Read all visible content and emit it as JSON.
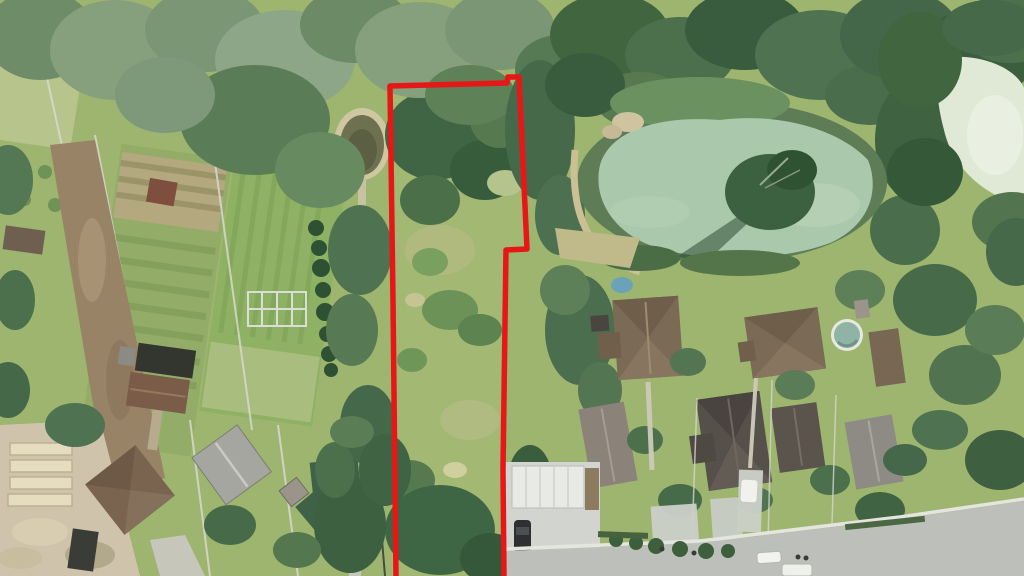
{
  "scene": {
    "description": "Aerial drone photograph of a long rural land plot outlined in red, flanked by garden allotments and a dirt road on the left, an algae-covered pond and detached houses with a residential street on the right",
    "type": "aerial-photo"
  },
  "boundary": {
    "color": "#e61717",
    "stroke_width": 5.5,
    "points": "396,578 393,300 390,86 507,83 508,77 519,77 527,249 506,250 503,470 504,578"
  },
  "palette": {
    "grass": "#9db56f",
    "plot_meadow": "#a2b873",
    "forest_dark": "#3c5f40",
    "willow_gray_green": "#86a07e",
    "pond_algae": "#aac8ab",
    "pond_pale": "#dfe9d6",
    "small_pond_water": "#6e7150",
    "small_pond_rim": "#cfc7a2",
    "dirt_road": "#998367",
    "construction_sand": "#cfc4ab",
    "asphalt": "#bcbfba",
    "concrete": "#d2d5cf",
    "roof_brown": "#7b6a55",
    "roof_dark": "#56504a",
    "roof_gray": "#a5a6a0",
    "roof_green": "#3e6147",
    "roof_red_brown": "#7e4f3e",
    "white_fence": "#d9d9d1",
    "car_white": "#f1f2ee",
    "car_dark": "#2e2f30",
    "pool_water": "#8fb3a4",
    "kiddie_pool": "#6aa3b8"
  },
  "features": {
    "outlined_plot": "vacant overgrown parcel marked with red boundary",
    "ponds": [
      "algae-pond",
      "corner-pond",
      "small-garden-pond"
    ],
    "street": "residential-street-bottom-right",
    "left_side": "garden-allotments-dirt-road-construction",
    "right_side": "detached-houses-with-pools"
  }
}
